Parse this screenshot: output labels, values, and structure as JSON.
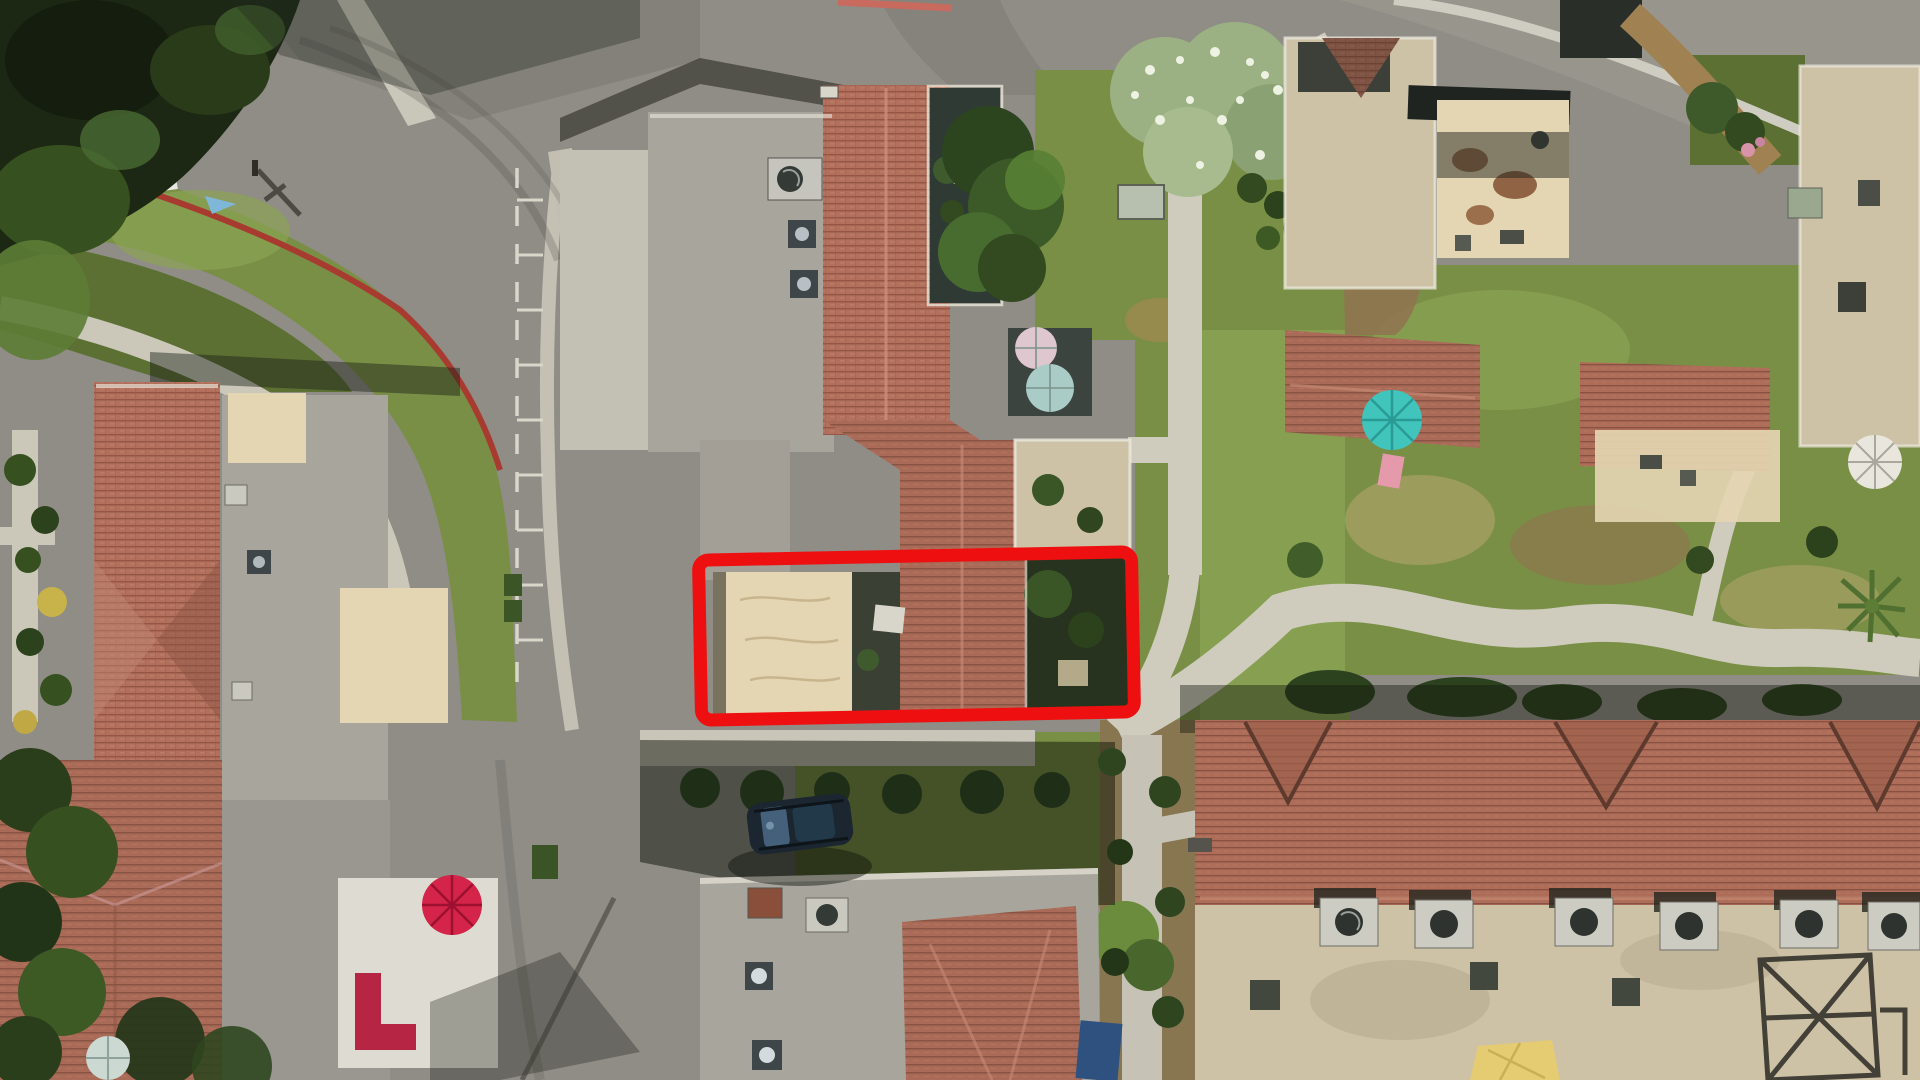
{
  "photo": {
    "kind": "aerial-drone-photo-of-townhome-community",
    "width_px": 1920,
    "height_px": 1080
  },
  "highlight": {
    "label": "subject-property-outline",
    "color": "#ee1010",
    "stroke_width": 13,
    "corner_radius": 10,
    "rotation_deg": -1.1
  },
  "palette": {
    "asphalt": "#8f8d86",
    "asphalt_light": "#a3a098",
    "concrete": "#cbc8ba",
    "concrete_bright": "#d9d6c9",
    "grass": "#7a8f46",
    "grass_bright": "#8aa353",
    "grass_dark": "#5c7034",
    "grass_shadowed": "#2f3e23",
    "canopy_dark": "#1d2814",
    "canopy_mid": "#37501f",
    "canopy_light": "#5d7c35",
    "blossom_tree": "#9cb183",
    "blossom_white": "#edf2e2",
    "tile_red": "#b2705d",
    "tile_red_dark": "#8f5040",
    "flat_roof": "#a7a59c",
    "flat_roof_dark": "#999790",
    "tan_court": "#e4d6b3",
    "tan_roof": "#cdc2a6",
    "parapet": "#e9e6da",
    "mulch": "#8f7350",
    "dirt_path": "#a3874f",
    "dry_grass": "#a59f63",
    "curb_red": "#a83b30",
    "umbrella_red": "#d42449",
    "umbrella_teal": "#41c4bc",
    "umbrella_pale_teal": "#a9ccc6",
    "umbrella_pink": "#dfc7cf",
    "umbrella_white": "#e9e6de",
    "umbrella_gray_teal": "#ccd8d2",
    "couch_red": "#b62544",
    "slide_pink": "#e59aac",
    "shade_sail_yellow": "#e5cb72",
    "car_body": "#1b2630",
    "car_glass": "#44607a",
    "spa_blue": "#2e5180",
    "skylight": "#3f464a",
    "ac_box": "#c9c9c0",
    "ac_fan": "#343a36",
    "shed": "#b7bfae",
    "stall_line": "#dcd9ce"
  }
}
